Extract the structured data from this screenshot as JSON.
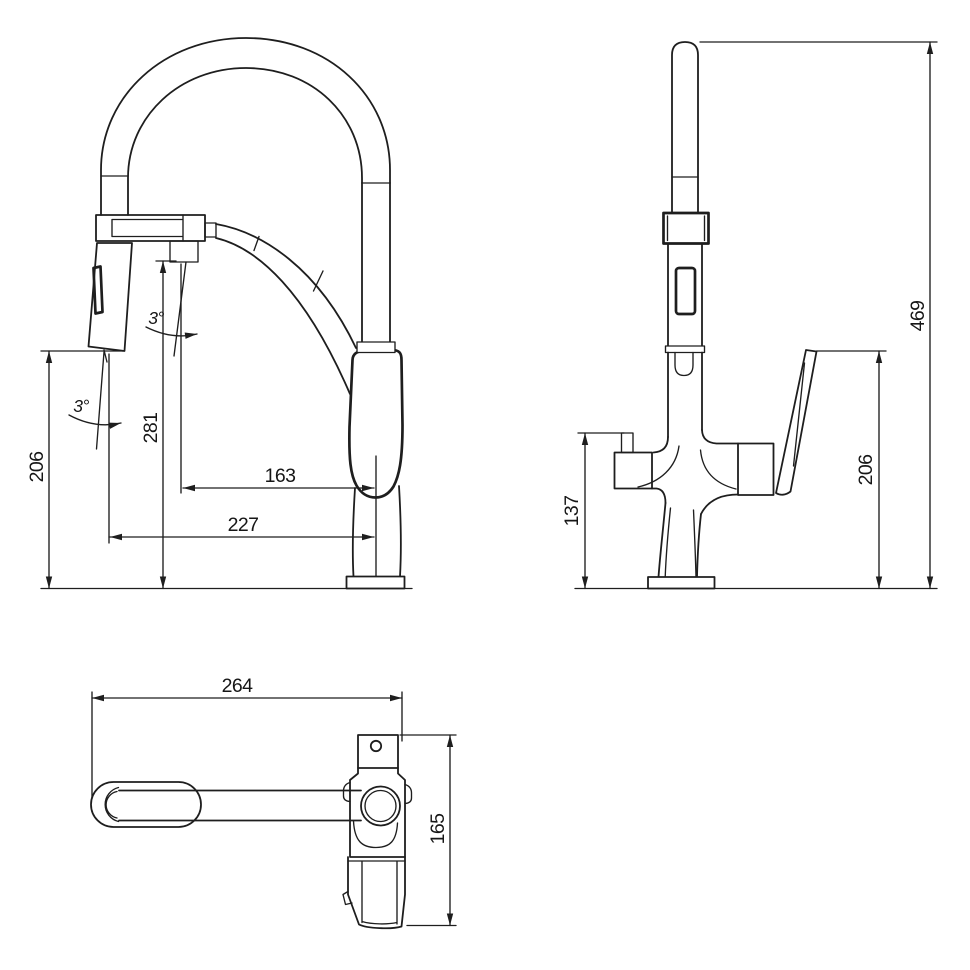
{
  "drawing": {
    "type": "faucet-installation-dimension-diagram",
    "line_color": "#1e1e1e",
    "background": "#ffffff",
    "views": {
      "front": {
        "dims": {
          "spray_height": "206",
          "holder_height": "281",
          "reach_inner": "163",
          "reach_outer": "227",
          "spray_angle": "3°",
          "holder_angle": "3°"
        }
      },
      "side": {
        "dims": {
          "overall_height": "469",
          "spout_height": "137",
          "handle_height": "206"
        }
      },
      "top": {
        "dims": {
          "overall_length": "264",
          "overall_depth": "165"
        }
      }
    }
  }
}
